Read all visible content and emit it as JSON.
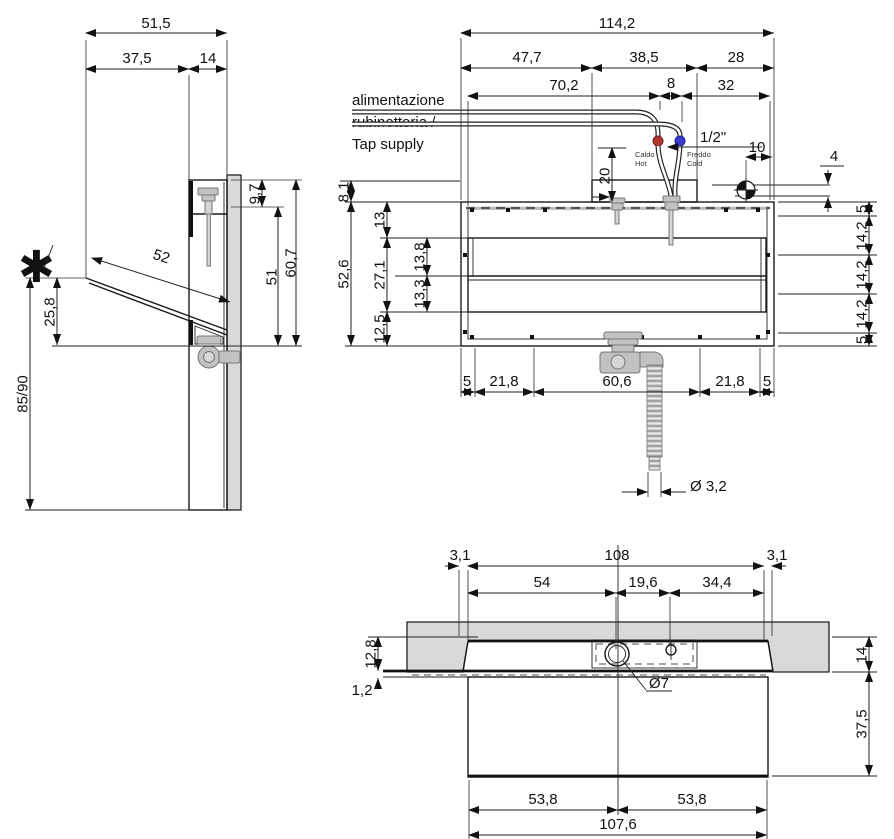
{
  "drawing": {
    "type": "technical-installation-drawing",
    "subject": "wall-mounted washbasin with cabinet, three orthographic views with dimensions"
  },
  "labels": {
    "tap_supply_line1": "alimentazione",
    "tap_supply_line2": "rubinetteria /",
    "tap_supply_line3": "Tap supply",
    "hot_line1": "Caldo",
    "hot_line2": "Hot",
    "cold_line1": "Freddo",
    "cold_line2": "Cold",
    "connection_size": "1/2\"",
    "footnote_marker": "✱"
  },
  "dims": {
    "side": {
      "overall_depth": "51,5",
      "basin_overhang": "37,5",
      "cabinet_depth": "14",
      "top_offset": "9,7",
      "inner_height": "51",
      "front_height": "60,7",
      "basin_slope_length": "52",
      "front_edge_height": "25,8",
      "mounting_height": "85/90"
    },
    "front": {
      "overall_width": "114,2",
      "left_span": "47,7",
      "mid_span": "38,5",
      "right_span": "28",
      "hot_offset": "70,2",
      "hot_cold_gap": "8",
      "cold_to_edge": "32",
      "hole_offset_h": "10",
      "hole_offset_v": "4",
      "riser_height": "20",
      "top_offset": "8,1",
      "overall_height": "52,6",
      "rim_height": "13",
      "inner_upper": "13,8",
      "inner_total": "27,1",
      "inner_lower": "13,3",
      "bottom_height": "12,5",
      "right_col": [
        "5",
        "14,2",
        "14,2",
        "14,2",
        "5"
      ],
      "bottom_row": [
        "5",
        "21,8",
        "60,6",
        "21,8",
        "5"
      ],
      "drain_hose_diameter": "Ø 3,2"
    },
    "bottom": {
      "edge_left": "3,1",
      "cutout_width": "108",
      "edge_right": "3,1",
      "drain_offset": "54",
      "drain_to_hole": "19,6",
      "hole_to_edge": "34,4",
      "recess_depth": "12,8",
      "lip": "1,2",
      "hole_diameter": "Ø7",
      "section_height": "14",
      "apron_height": "37,5",
      "apron_half_left": "53,8",
      "apron_half_right": "53,8",
      "apron_width": "107,6"
    }
  },
  "colors": {
    "hot": "#b03a30",
    "cold": "#3b3bd1",
    "wall_gray": "#d9d9d9",
    "fixture_gray": "#c2c2c2",
    "line": "#1a1a1a"
  }
}
